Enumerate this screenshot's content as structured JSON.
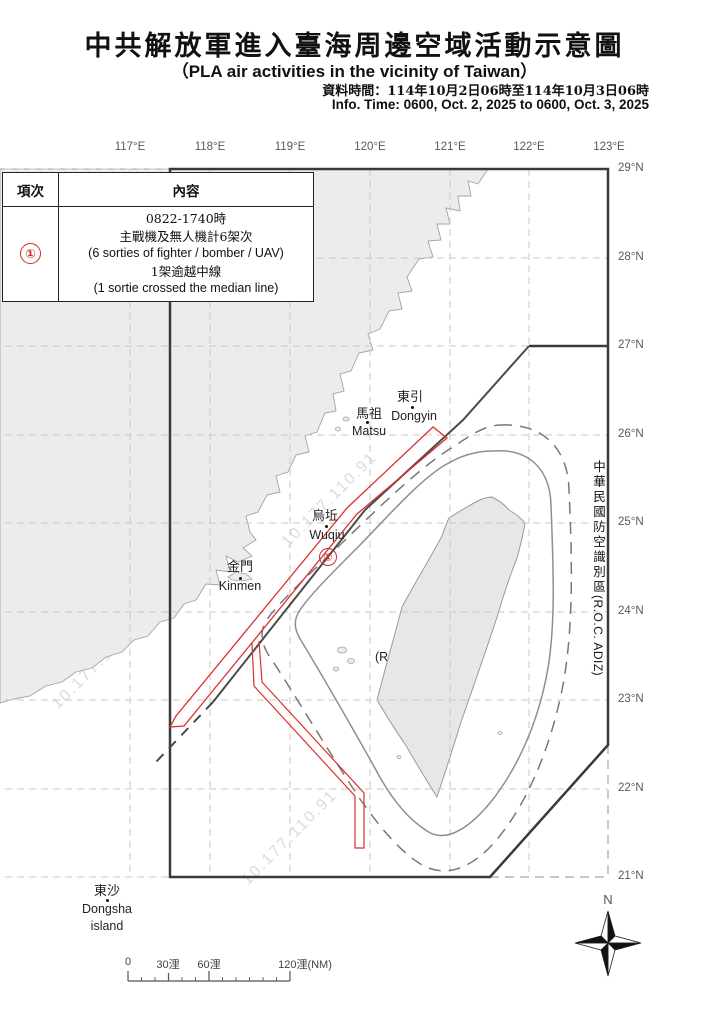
{
  "title": {
    "main": "中共解放軍進入臺海周邊空域活動示意圖",
    "subtitle": "（PLA air activities in the vicinity  of Taiwan）",
    "info_time_cn": "資料時間：114年10月2日06時至114年10月3日06時",
    "info_time_en": "Info. Time: 0600, Oct. 2, 2025 to 0600, Oct. 3, 2025"
  },
  "table": {
    "col_item": "項次",
    "col_content": "內容",
    "row": {
      "num": "①",
      "lines": [
        "0822-1740時",
        "主戰機及無人機計6架次",
        "(6  sorties of fighter / bomber / UAV)",
        "1架逾越中線",
        "(1 sortie crossed the median line)"
      ]
    }
  },
  "map": {
    "lon_labels": [
      "117°E",
      "118°E",
      "119°E",
      "120°E",
      "121°E",
      "122°E",
      "123°E"
    ],
    "lat_labels": [
      "29°N",
      "28°N",
      "27°N",
      "26°N",
      "25°N",
      "24°N",
      "23°N",
      "22°N",
      "21°N"
    ],
    "marker": "①",
    "watermark": "10.177.110.91",
    "places": {
      "dongyin": {
        "cn": "東引",
        "en": "Dongyin"
      },
      "matsu": {
        "cn": "馬祖",
        "en": "Matsu"
      },
      "wuqiu": {
        "cn": "烏坵",
        "en": "Wuqiu"
      },
      "kinmen": {
        "cn": "金門",
        "en": "Kinmen"
      },
      "dongsha": {
        "cn": "東沙",
        "en": "Dongsha",
        "en2": "island"
      }
    },
    "taiwan": {
      "cn": "中華民國",
      "en": "(R.O.C.)"
    },
    "adiz": {
      "cn": "中華民國防空識別區",
      "en": "(R.O.C. ADIZ)"
    }
  },
  "scale": {
    "labels": [
      "0",
      "30浬",
      "60浬",
      "120浬(NM)"
    ]
  },
  "compass": {
    "n": "N"
  },
  "colors": {
    "accent_red": "#cf2b24",
    "boundary_dark": "#3a3a3a",
    "land_gray": "#ececec"
  }
}
